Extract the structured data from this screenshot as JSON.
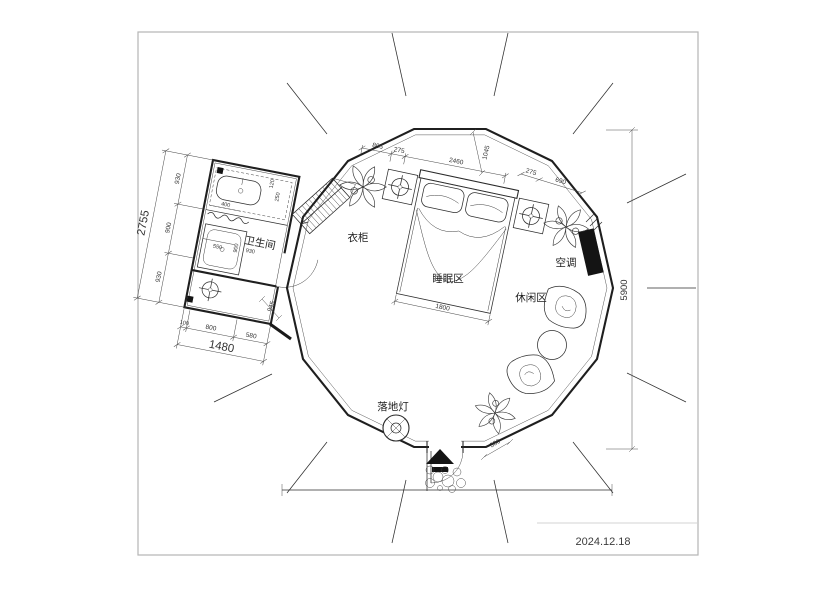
{
  "date": "2024.12.18",
  "labels": {
    "bathroom": "卫生间",
    "wardrobe": "衣柜",
    "sleeping_area": "睡眠区",
    "leisure_area": "休闲区",
    "air_conditioner": "空调",
    "floor_lamp": "落地灯"
  },
  "dims": {
    "top_805": "805",
    "top_275l": "275",
    "top_2460": "2460",
    "top_1045": "1045",
    "right_275": "275",
    "right_690": "690",
    "left_930a": "930",
    "left_900": "900",
    "left_930b": "930",
    "left_total": "2755",
    "bottom_100": "100",
    "bottom_800": "800",
    "bottom_580": "580",
    "bottom_total": "1480",
    "bed_width": "1800",
    "height_total": "5900",
    "entrance": "380",
    "edge_945": "945",
    "bath_400": "400",
    "bath_550": "550",
    "bath_900": "900",
    "bath_930": "930",
    "bath_120": "120",
    "bath_250": "250"
  },
  "colors": {
    "line": "#2e2e2e",
    "fill_black": "#141414",
    "frame": "#b5b5b5",
    "background": "#ffffff"
  }
}
